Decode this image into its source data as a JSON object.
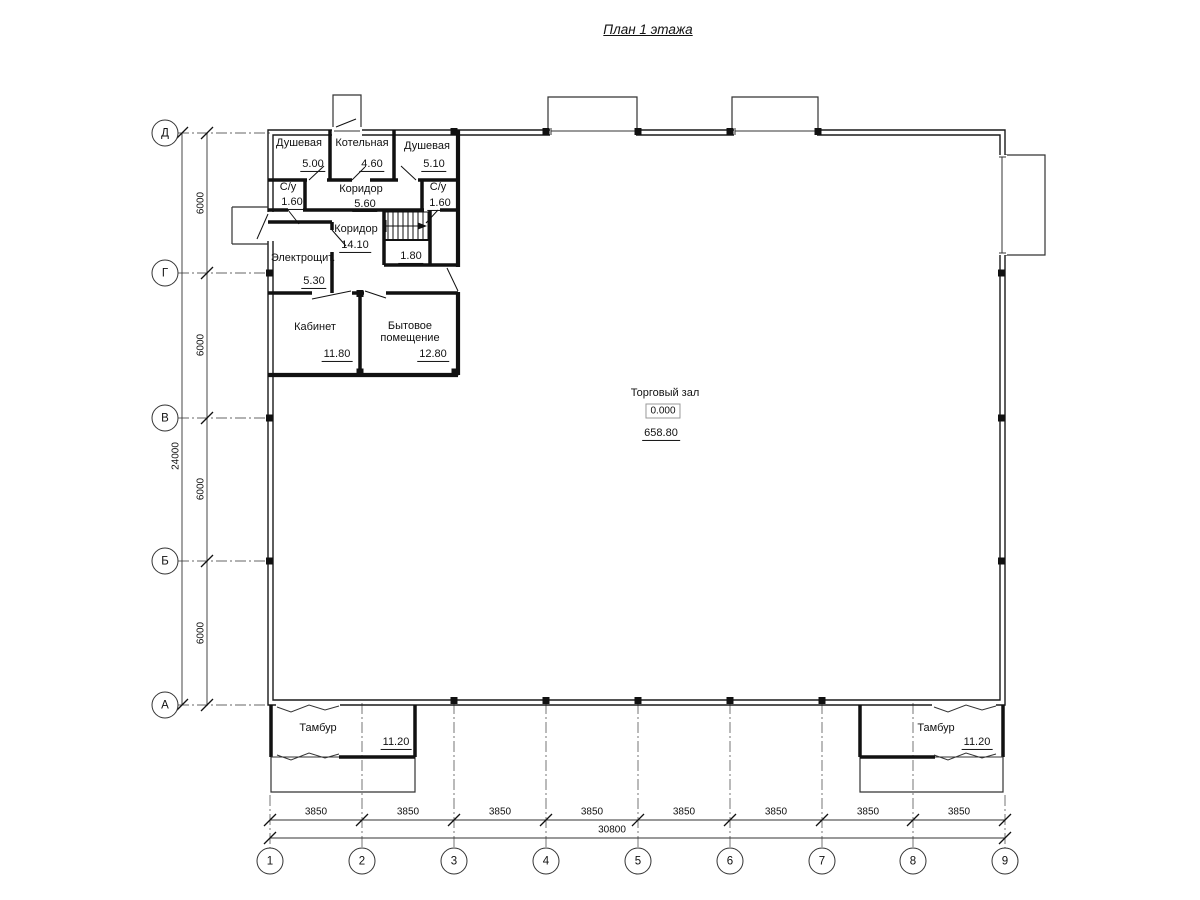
{
  "title": "План 1 этажа",
  "axes": {
    "rows": [
      "Д",
      "Г",
      "В",
      "Б",
      "А"
    ],
    "cols": [
      "1",
      "2",
      "3",
      "4",
      "5",
      "6",
      "7",
      "8",
      "9"
    ]
  },
  "dimensions": {
    "vertical_segments": [
      "6000",
      "6000",
      "6000",
      "6000"
    ],
    "vertical_total": "24000",
    "horizontal_segments": [
      "3850",
      "3850",
      "3850",
      "3850",
      "3850",
      "3850",
      "3850",
      "3850"
    ],
    "horizontal_total": "30800"
  },
  "rooms": {
    "shower_left": {
      "name": "Душевая",
      "area": "5.00"
    },
    "boiler": {
      "name": "Котельная",
      "area": "4.60"
    },
    "shower_right": {
      "name": "Душевая",
      "area": "5.10"
    },
    "wc_left": {
      "name": "С/у",
      "area": "1.60"
    },
    "corridor_small": {
      "name": "Коридор",
      "area": "5.60"
    },
    "wc_right": {
      "name": "С/у",
      "area": "1.60"
    },
    "corridor_main": {
      "name": "Коридор",
      "area": "14.10"
    },
    "under_stairs": {
      "area": "1.80"
    },
    "electrical": {
      "name": "Электрощит.",
      "area": "5.30"
    },
    "office": {
      "name": "Кабинет",
      "area": "11.80"
    },
    "utility": {
      "name_line1": "Бытовое",
      "name_line2": "помещение",
      "area": "12.80"
    },
    "sales_hall": {
      "name": "Торговый зал",
      "elevation": "0.000",
      "area": "658.80"
    },
    "vestibule_left": {
      "name": "Тамбур",
      "area": "11.20"
    },
    "vestibule_right": {
      "name": "Тамбур",
      "area": "11.20"
    }
  }
}
